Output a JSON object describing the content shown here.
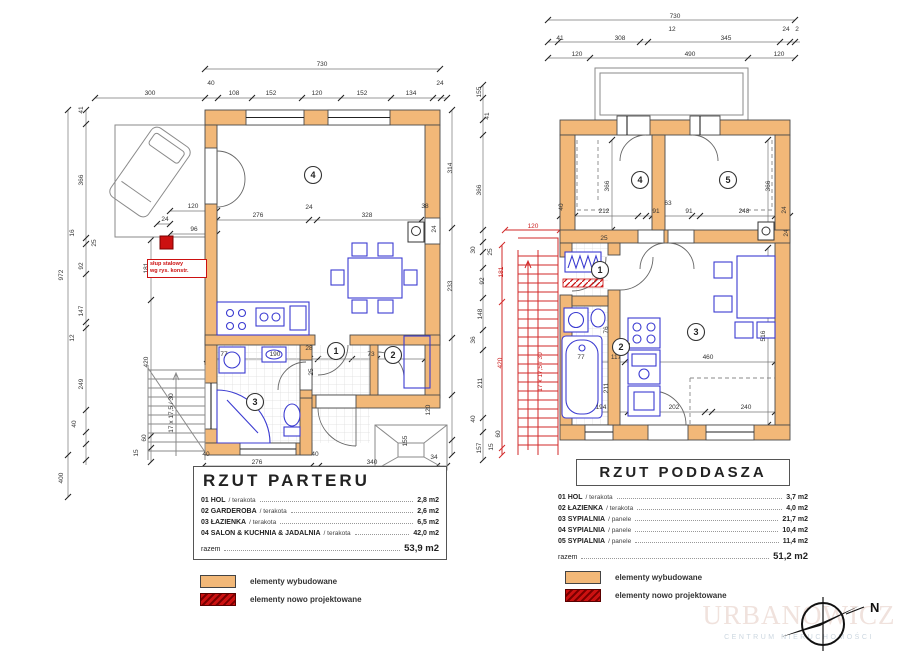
{
  "colors": {
    "wall_existing": "#f2b878",
    "new_elements": "#cc1111",
    "furniture_blue": "#3b3bd1",
    "dim_text": "#333333"
  },
  "compass": {
    "north_label": "N"
  },
  "watermark": {
    "line1": "URBANOWICZ",
    "line2": "CENTRUM NIERUCHOMOŚCI"
  },
  "legend": {
    "existing_label": "elementy wybudowane",
    "new_label": "elementy nowo projektowane"
  },
  "plans": [
    {
      "id": "parter",
      "title": "RZUT PARTERU",
      "schedule": [
        {
          "no": "01",
          "name": "HOL",
          "finish": "terakota",
          "area": "2,8 m2"
        },
        {
          "no": "02",
          "name": "GARDEROBA",
          "finish": "terakota",
          "area": "2,6 m2"
        },
        {
          "no": "03",
          "name": "ŁAZIENKA",
          "finish": "terakota",
          "area": "6,5 m2"
        },
        {
          "no": "04",
          "name": "SALON & KUCHNIA & JADALNIA",
          "finish": "terakota",
          "area": "42,0 m2"
        }
      ],
      "total_label": "razem",
      "total_value": "53,9 m2",
      "note_lines": [
        "słup stalowy",
        "wg rys. konstr."
      ],
      "rooms": [
        {
          "n": "4",
          "x": 313,
          "y": 175
        },
        {
          "n": "1",
          "x": 336,
          "y": 351
        },
        {
          "n": "2",
          "x": 393,
          "y": 355
        },
        {
          "n": "3",
          "x": 255,
          "y": 402
        }
      ],
      "dims": [
        {
          "t": "730",
          "x": 322,
          "y": 66
        },
        {
          "t": "300",
          "x": 150,
          "y": 95
        },
        {
          "t": "40",
          "x": 211,
          "y": 85
        },
        {
          "t": "108",
          "x": 234,
          "y": 95
        },
        {
          "t": "152",
          "x": 271,
          "y": 95
        },
        {
          "t": "120",
          "x": 317,
          "y": 95
        },
        {
          "t": "152",
          "x": 362,
          "y": 95
        },
        {
          "t": "134",
          "x": 411,
          "y": 95
        },
        {
          "t": "24",
          "x": 440,
          "y": 85
        },
        {
          "t": "972",
          "x": 63,
          "y": 275,
          "r": 1
        },
        {
          "t": "41",
          "x": 83,
          "y": 110,
          "r": 1
        },
        {
          "t": "366",
          "x": 83,
          "y": 180,
          "r": 1
        },
        {
          "t": "16",
          "x": 74,
          "y": 233,
          "r": 1
        },
        {
          "t": "25",
          "x": 96,
          "y": 243,
          "r": 1
        },
        {
          "t": "92",
          "x": 83,
          "y": 266,
          "r": 1
        },
        {
          "t": "147",
          "x": 83,
          "y": 311,
          "r": 1
        },
        {
          "t": "12",
          "x": 74,
          "y": 338,
          "r": 1
        },
        {
          "t": "249",
          "x": 83,
          "y": 384,
          "r": 1
        },
        {
          "t": "40",
          "x": 76,
          "y": 424,
          "r": 1
        },
        {
          "t": "60",
          "x": 146,
          "y": 438,
          "r": 1
        },
        {
          "t": "15",
          "x": 138,
          "y": 453,
          "r": 1
        },
        {
          "t": "400",
          "x": 63,
          "y": 478,
          "r": 1
        },
        {
          "t": "181",
          "x": 148,
          "y": 268,
          "r": 1
        },
        {
          "t": "420",
          "x": 148,
          "y": 362,
          "r": 1
        },
        {
          "t": "120",
          "x": 193,
          "y": 208
        },
        {
          "t": "24",
          "x": 165,
          "y": 221
        },
        {
          "t": "96",
          "x": 194,
          "y": 231
        },
        {
          "t": "276",
          "x": 258,
          "y": 217
        },
        {
          "t": "24",
          "x": 309,
          "y": 209
        },
        {
          "t": "328",
          "x": 367,
          "y": 217
        },
        {
          "t": "38",
          "x": 425,
          "y": 208
        },
        {
          "t": "24",
          "x": 436,
          "y": 229,
          "r": 1
        },
        {
          "t": "314",
          "x": 452,
          "y": 168,
          "r": 1
        },
        {
          "t": "233",
          "x": 452,
          "y": 286,
          "r": 1
        },
        {
          "t": "120",
          "x": 430,
          "y": 410,
          "r": 1
        },
        {
          "t": "155",
          "x": 407,
          "y": 441,
          "r": 1
        },
        {
          "t": "34",
          "x": 434,
          "y": 459
        },
        {
          "t": "77",
          "x": 224,
          "y": 356
        },
        {
          "t": "190",
          "x": 275,
          "y": 356
        },
        {
          "t": "28",
          "x": 309,
          "y": 350
        },
        {
          "t": "101",
          "x": 337,
          "y": 356
        },
        {
          "t": "73",
          "x": 371,
          "y": 356
        },
        {
          "t": "25",
          "x": 313,
          "y": 372,
          "r": 1
        },
        {
          "t": "40",
          "x": 206,
          "y": 456
        },
        {
          "t": "276",
          "x": 257,
          "y": 464
        },
        {
          "t": "40",
          "x": 315,
          "y": 456
        },
        {
          "t": "340",
          "x": 372,
          "y": 464
        },
        {
          "t": "17 x 17,5 / 30",
          "x": 173,
          "y": 413,
          "r": 1
        }
      ]
    },
    {
      "id": "poddasze",
      "title": "RZUT PODDASZA",
      "schedule": [
        {
          "no": "01",
          "name": "HOL",
          "finish": "terakota",
          "area": "3,7 m2"
        },
        {
          "no": "02",
          "name": "ŁAZIENKA",
          "finish": "terakota",
          "area": "4,0 m2"
        },
        {
          "no": "03",
          "name": "SYPIALNIA",
          "finish": "panele",
          "area": "21,7 m2"
        },
        {
          "no": "04",
          "name": "SYPIALNIA",
          "finish": "panele",
          "area": "10,4 m2"
        },
        {
          "no": "05",
          "name": "SYPIALNIA",
          "finish": "panele",
          "area": "11,4 m2"
        }
      ],
      "total_label": "razem",
      "total_value": "51,2 m2",
      "rooms": [
        {
          "n": "4",
          "x": 640,
          "y": 180
        },
        {
          "n": "5",
          "x": 728,
          "y": 180
        },
        {
          "n": "1",
          "x": 600,
          "y": 270
        },
        {
          "n": "2",
          "x": 621,
          "y": 347
        },
        {
          "n": "3",
          "x": 696,
          "y": 332
        }
      ],
      "dims": [
        {
          "t": "730",
          "x": 675,
          "y": 18
        },
        {
          "t": "12",
          "x": 672,
          "y": 31
        },
        {
          "t": "24",
          "x": 786,
          "y": 31
        },
        {
          "t": "2",
          "x": 797,
          "y": 31
        },
        {
          "t": "41",
          "x": 560,
          "y": 40
        },
        {
          "t": "308",
          "x": 620,
          "y": 40
        },
        {
          "t": "345",
          "x": 726,
          "y": 40
        },
        {
          "t": "120",
          "x": 577,
          "y": 56
        },
        {
          "t": "490",
          "x": 690,
          "y": 56
        },
        {
          "t": "120",
          "x": 779,
          "y": 56
        },
        {
          "t": "155",
          "x": 481,
          "y": 92,
          "r": 1
        },
        {
          "t": "41",
          "x": 489,
          "y": 116,
          "r": 1
        },
        {
          "t": "366",
          "x": 481,
          "y": 190,
          "r": 1
        },
        {
          "t": "30",
          "x": 475,
          "y": 250,
          "r": 1
        },
        {
          "t": "25",
          "x": 492,
          "y": 252,
          "r": 1
        },
        {
          "t": "92",
          "x": 484,
          "y": 281,
          "r": 1
        },
        {
          "t": "148",
          "x": 482,
          "y": 314,
          "r": 1
        },
        {
          "t": "36",
          "x": 475,
          "y": 340,
          "r": 1
        },
        {
          "t": "211",
          "x": 482,
          "y": 383,
          "r": 1
        },
        {
          "t": "40",
          "x": 475,
          "y": 419,
          "r": 1
        },
        {
          "t": "157",
          "x": 481,
          "y": 448,
          "r": 1
        },
        {
          "t": "60",
          "x": 500,
          "y": 434,
          "r": 1
        },
        {
          "t": "15",
          "x": 493,
          "y": 447,
          "r": 1
        },
        {
          "t": "120",
          "x": 533,
          "y": 228,
          "red": 1
        },
        {
          "t": "181",
          "x": 503,
          "y": 272,
          "r": 1,
          "red": 1
        },
        {
          "t": "420",
          "x": 502,
          "y": 363,
          "r": 1,
          "red": 1
        },
        {
          "t": "212",
          "x": 604,
          "y": 213
        },
        {
          "t": "91",
          "x": 656,
          "y": 213
        },
        {
          "t": "91",
          "x": 689,
          "y": 213
        },
        {
          "t": "248",
          "x": 744,
          "y": 213
        },
        {
          "t": "63",
          "x": 668,
          "y": 205
        },
        {
          "t": "40",
          "x": 563,
          "y": 207,
          "r": 1
        },
        {
          "t": "24",
          "x": 786,
          "y": 210,
          "r": 1
        },
        {
          "t": "25",
          "x": 604,
          "y": 240
        },
        {
          "t": "366",
          "x": 609,
          "y": 186,
          "r": 1
        },
        {
          "t": "366",
          "x": 770,
          "y": 186,
          "r": 1
        },
        {
          "t": "24",
          "x": 788,
          "y": 233,
          "r": 1
        },
        {
          "t": "516",
          "x": 765,
          "y": 336,
          "r": 1
        },
        {
          "t": "77",
          "x": 581,
          "y": 359
        },
        {
          "t": "117",
          "x": 616,
          "y": 359
        },
        {
          "t": "460",
          "x": 708,
          "y": 359
        },
        {
          "t": "76",
          "x": 608,
          "y": 330,
          "r": 1
        },
        {
          "t": "211",
          "x": 608,
          "y": 388,
          "r": 1
        },
        {
          "t": "36",
          "x": 630,
          "y": 346,
          "r": 1
        },
        {
          "t": "194",
          "x": 601,
          "y": 409
        },
        {
          "t": "202",
          "x": 674,
          "y": 409
        },
        {
          "t": "240",
          "x": 746,
          "y": 409
        },
        {
          "t": "17 x 17,5 / 30",
          "x": 542,
          "y": 372,
          "r": 1,
          "red": 1
        }
      ]
    }
  ]
}
